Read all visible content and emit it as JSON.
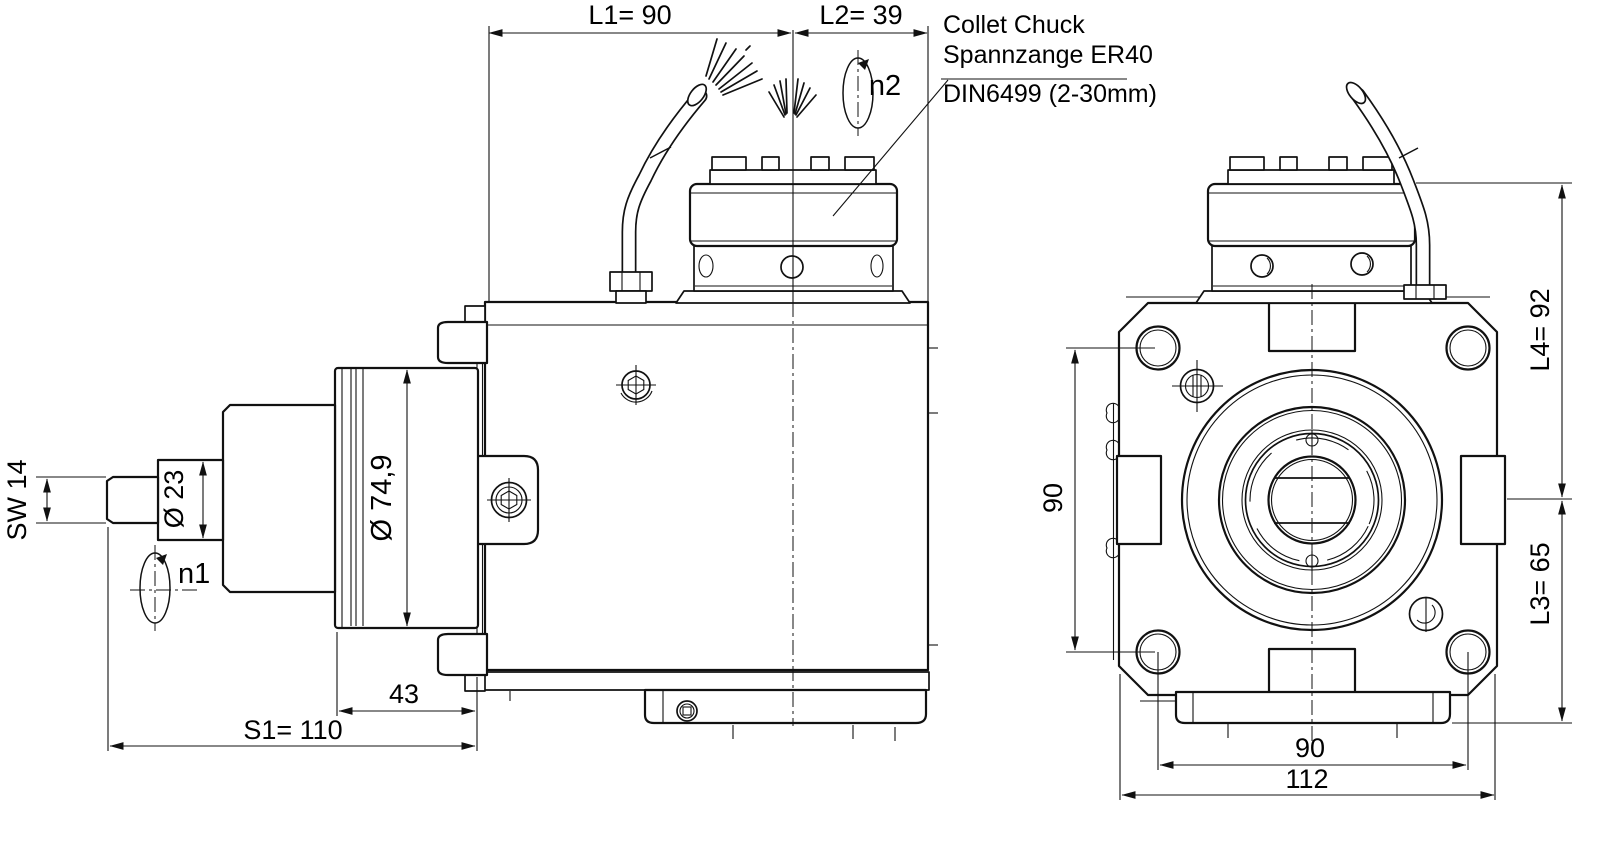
{
  "annotation": {
    "line1": "Collet Chuck",
    "line2": "Spannzange ER40",
    "line3": "DIN6499 (2-30mm)"
  },
  "dims": {
    "l1": "L1= 90",
    "l2": "L2= 39",
    "sw": "SW 14",
    "dia23": "Ø 23",
    "dia749": "Ø 74,9",
    "n1": "n1",
    "n2": "n2",
    "len43": "43",
    "s1": "S1= 110",
    "front_height_90": "90",
    "l4": "L4= 92",
    "l3": "L3= 65",
    "front_width_90": "90",
    "front_width_112": "112"
  },
  "colors": {
    "line": "#111111",
    "background": "#ffffff"
  }
}
